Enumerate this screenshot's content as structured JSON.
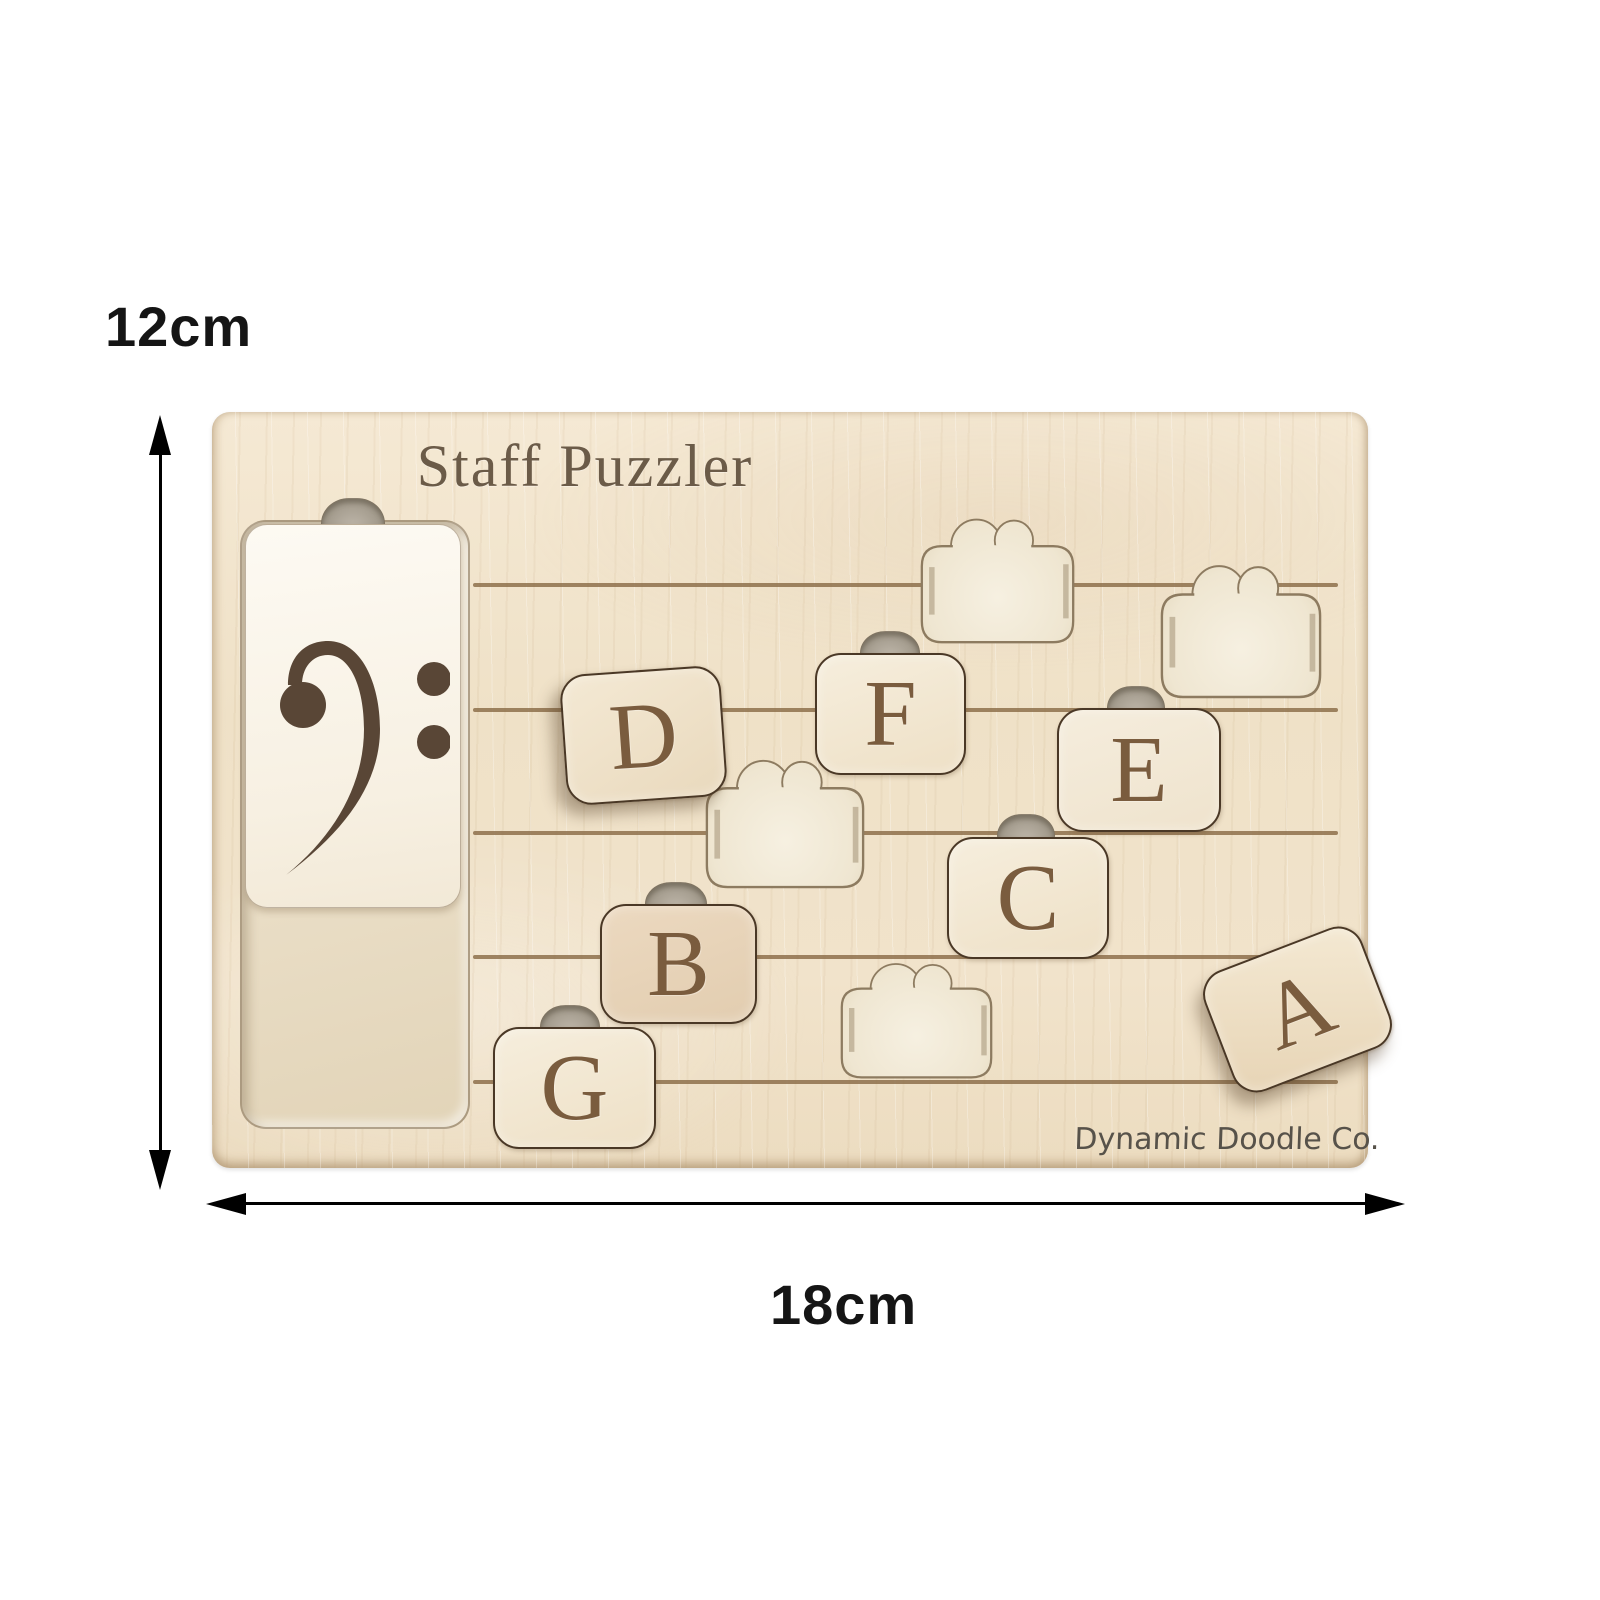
{
  "annotations": {
    "height_label": "12cm",
    "width_label": "18cm"
  },
  "board": {
    "title": "Staff Puzzler",
    "brand": "Dynamic Doodle Co.",
    "clef": "bass-clef",
    "staff_line_count": 5,
    "empty_slot_count": 4,
    "tiles": [
      {
        "letter": "D",
        "state": "loose"
      },
      {
        "letter": "F",
        "state": "in-slot"
      },
      {
        "letter": "E",
        "state": "in-slot"
      },
      {
        "letter": "C",
        "state": "in-slot"
      },
      {
        "letter": "B",
        "state": "in-slot"
      },
      {
        "letter": "G",
        "state": "in-slot"
      },
      {
        "letter": "A",
        "state": "loose"
      }
    ]
  },
  "colors": {
    "wood": "#f0e2ca",
    "staff_line": "#8a6b47",
    "tile_outline": "#4a3826",
    "letter_engraving": "#7a5c3e",
    "clef": "#594636",
    "recess_floor": "#efe6d1",
    "label_text": "#151515"
  }
}
